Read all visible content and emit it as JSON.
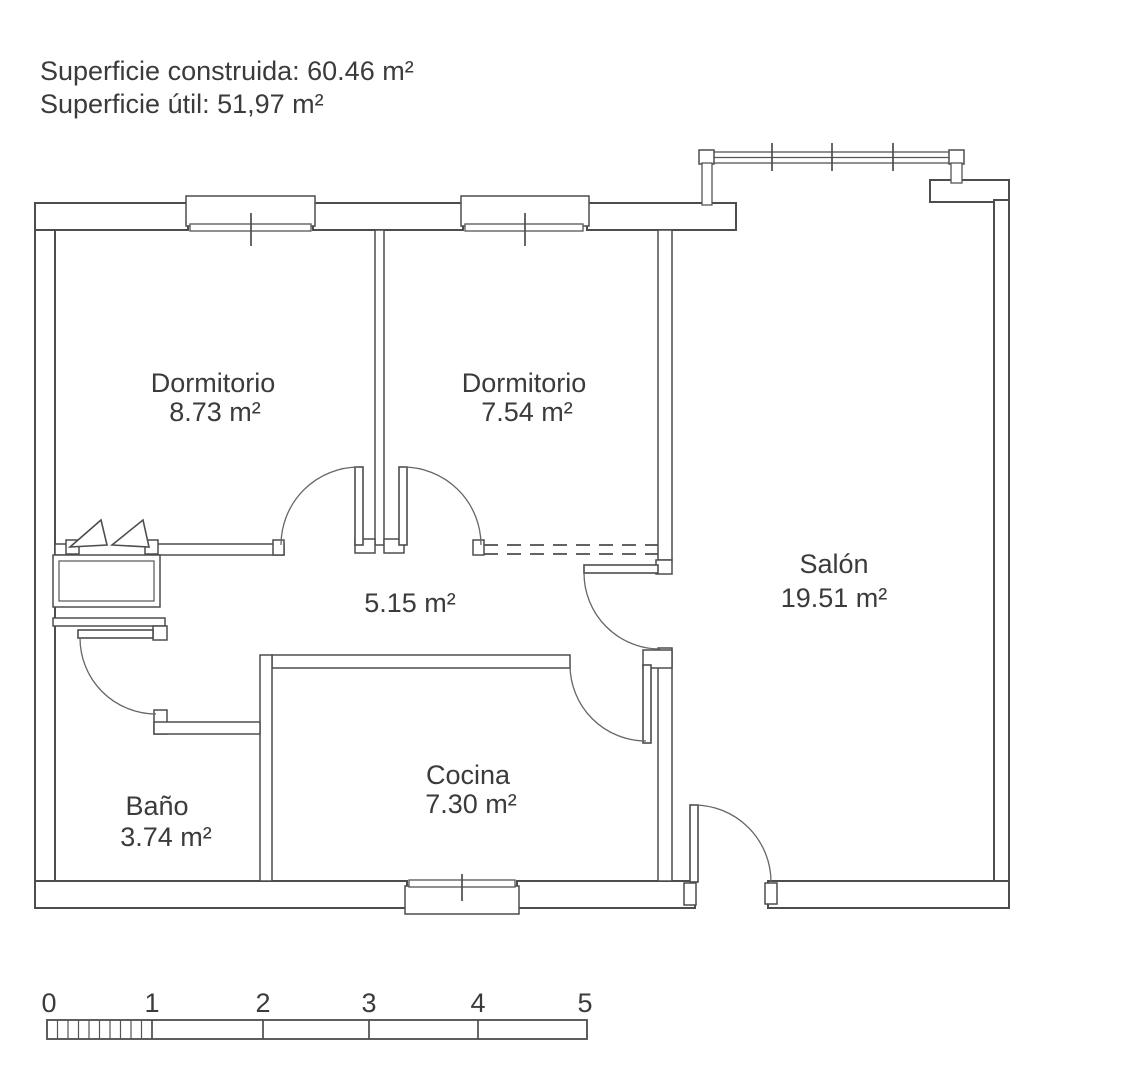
{
  "colors": {
    "background": "#ffffff",
    "line": "#4d4d4d",
    "text": "#3b3b3b"
  },
  "header": {
    "line1": "Superficie construida: 60.46 m²",
    "line2": "Superficie útil: 51,97 m²"
  },
  "rooms": {
    "bedroom1": {
      "name": "Dormitorio",
      "area": "8.73 m²"
    },
    "bedroom2": {
      "name": "Dormitorio",
      "area": "7.54 m²"
    },
    "salon": {
      "name": "Salón",
      "area": "19.51 m²"
    },
    "hallway": {
      "area": "5.15 m²"
    },
    "bathroom": {
      "name": "Baño",
      "area": "3.74 m²"
    },
    "kitchen": {
      "name": "Cocina",
      "area": "7.30 m²"
    }
  },
  "scale_bar": {
    "unit_labels": [
      "0",
      "1",
      "2",
      "3",
      "4",
      "5"
    ]
  }
}
